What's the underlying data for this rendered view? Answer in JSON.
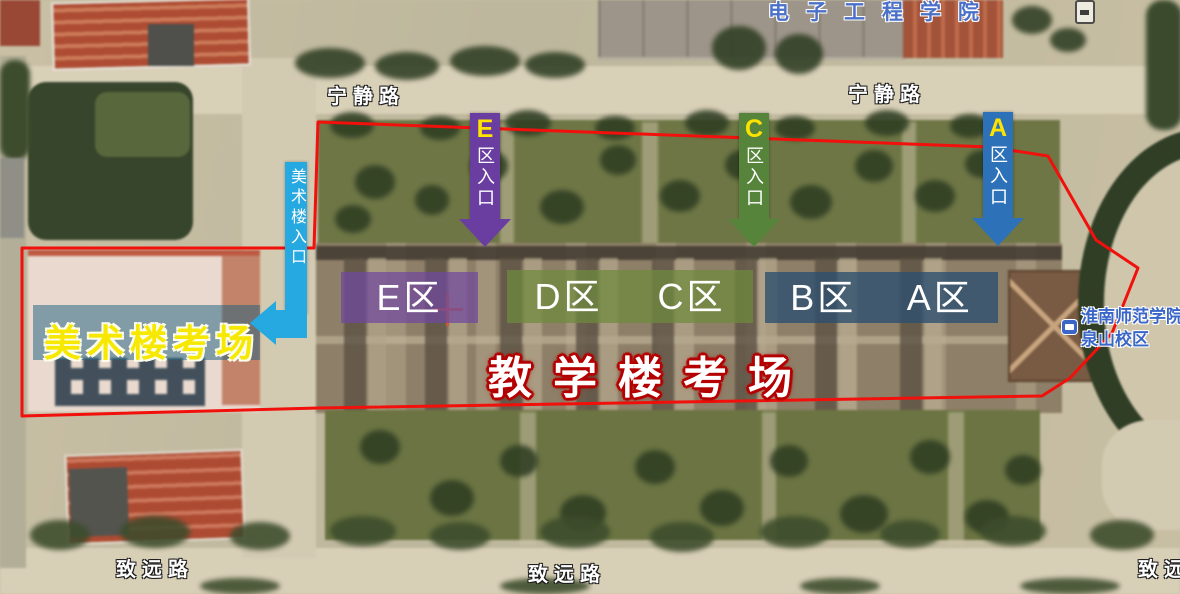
{
  "labels": {
    "ningjing_road_1": "宁静路",
    "ningjing_road_2": "宁静路",
    "zhiyuan_road_1": "致远路",
    "zhiyuan_road_2": "致远路",
    "zhiyuan_road_3": "致远路",
    "electronics_college": "电子工程学院",
    "campus_line1": "淮南师范学院",
    "campus_line2": "泉山校区",
    "teaching_venue": "教学楼考场",
    "art_venue": "美术楼考场",
    "art_entrance": "美术楼入口"
  },
  "entrances": {
    "e": {
      "letter": "E",
      "suffix": "区入口"
    },
    "c": {
      "letter": "C",
      "suffix": "区入口"
    },
    "a": {
      "letter": "A",
      "suffix": "区入口"
    }
  },
  "zones": {
    "e": "E区",
    "d": "D区",
    "c": "C区",
    "b": "B区",
    "a": "A区"
  },
  "colors": {
    "boundary_red": "#f1100b",
    "entrance_e_purple": "#6a3da0",
    "entrance_c_green": "#55843a",
    "entrance_a_blue": "#2d72b8",
    "entrance_art_cyan": "#25a9e0",
    "band_purple": "rgba(112,72,158,0.72)",
    "band_green": "rgba(110,138,60,0.72)",
    "band_blue": "rgba(44,78,112,0.78)",
    "art_band_teal": "rgba(25,95,125,0.5)",
    "art_venue_yellow": "#f6e800",
    "teaching_outline_red": "#b40000",
    "poi_blue": "#4a70c8",
    "campus_blue": "#3a66c8",
    "arrow_letter_yellow": "#ffe300"
  }
}
